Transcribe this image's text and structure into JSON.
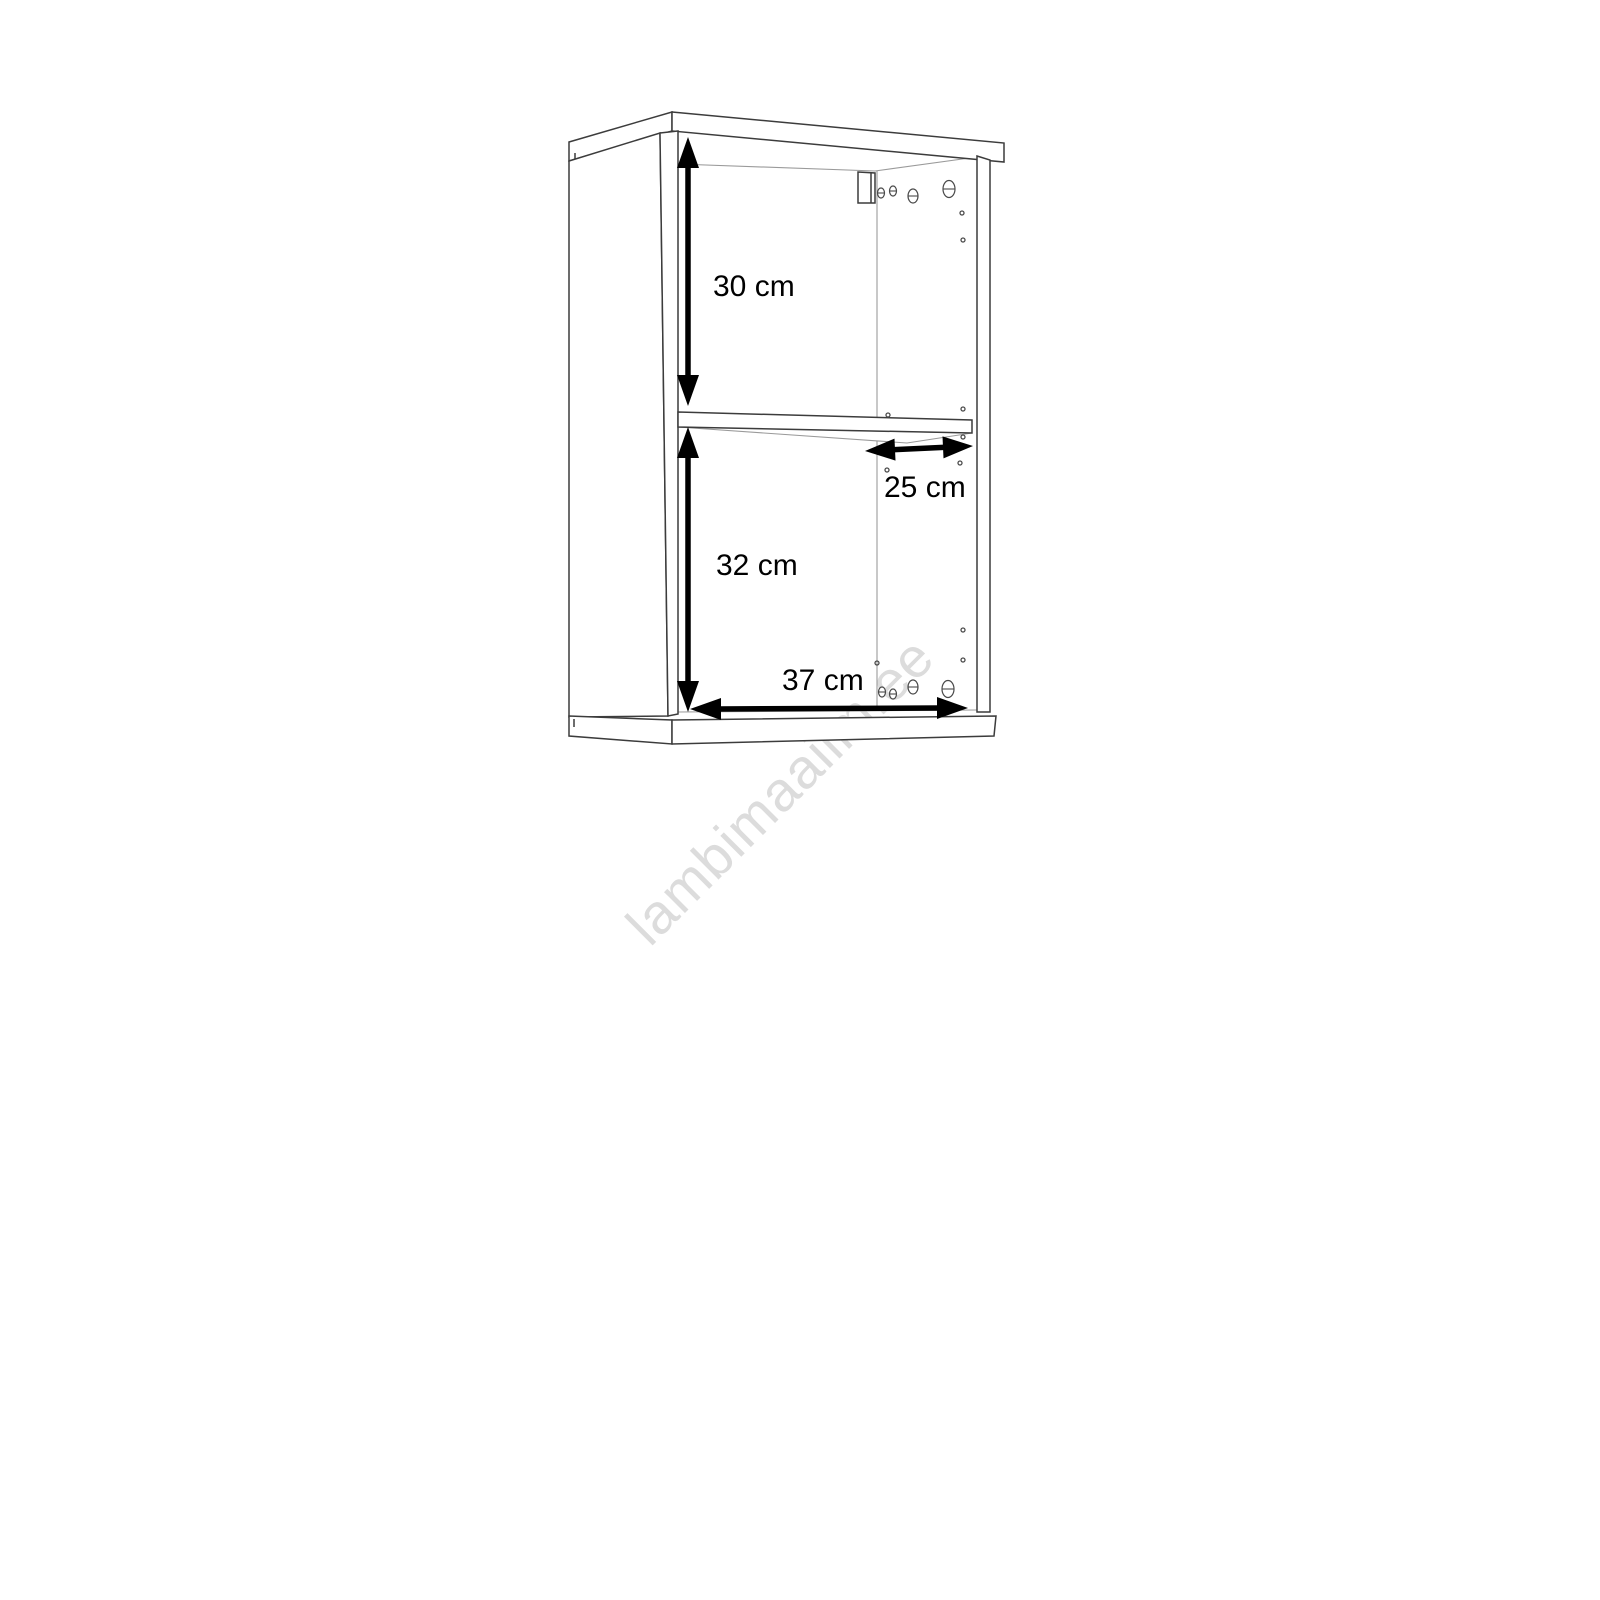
{
  "page": {
    "background": "#ffffff"
  },
  "drawing": {
    "kind": "cabinet-dimension-line-drawing",
    "dimension_labels": {
      "upper_compartment_height": "30 cm",
      "shelf_depth": "25 cm",
      "lower_compartment_height": "32 cm",
      "interior_width": "37 cm"
    },
    "watermark_text": "lambimaailm.ee",
    "colors": {
      "outline": "#3c3c3c",
      "outline_light": "#9a9a9a",
      "dimension": "#000000",
      "watermark": "#dcdcdc",
      "background": "#ffffff"
    }
  }
}
